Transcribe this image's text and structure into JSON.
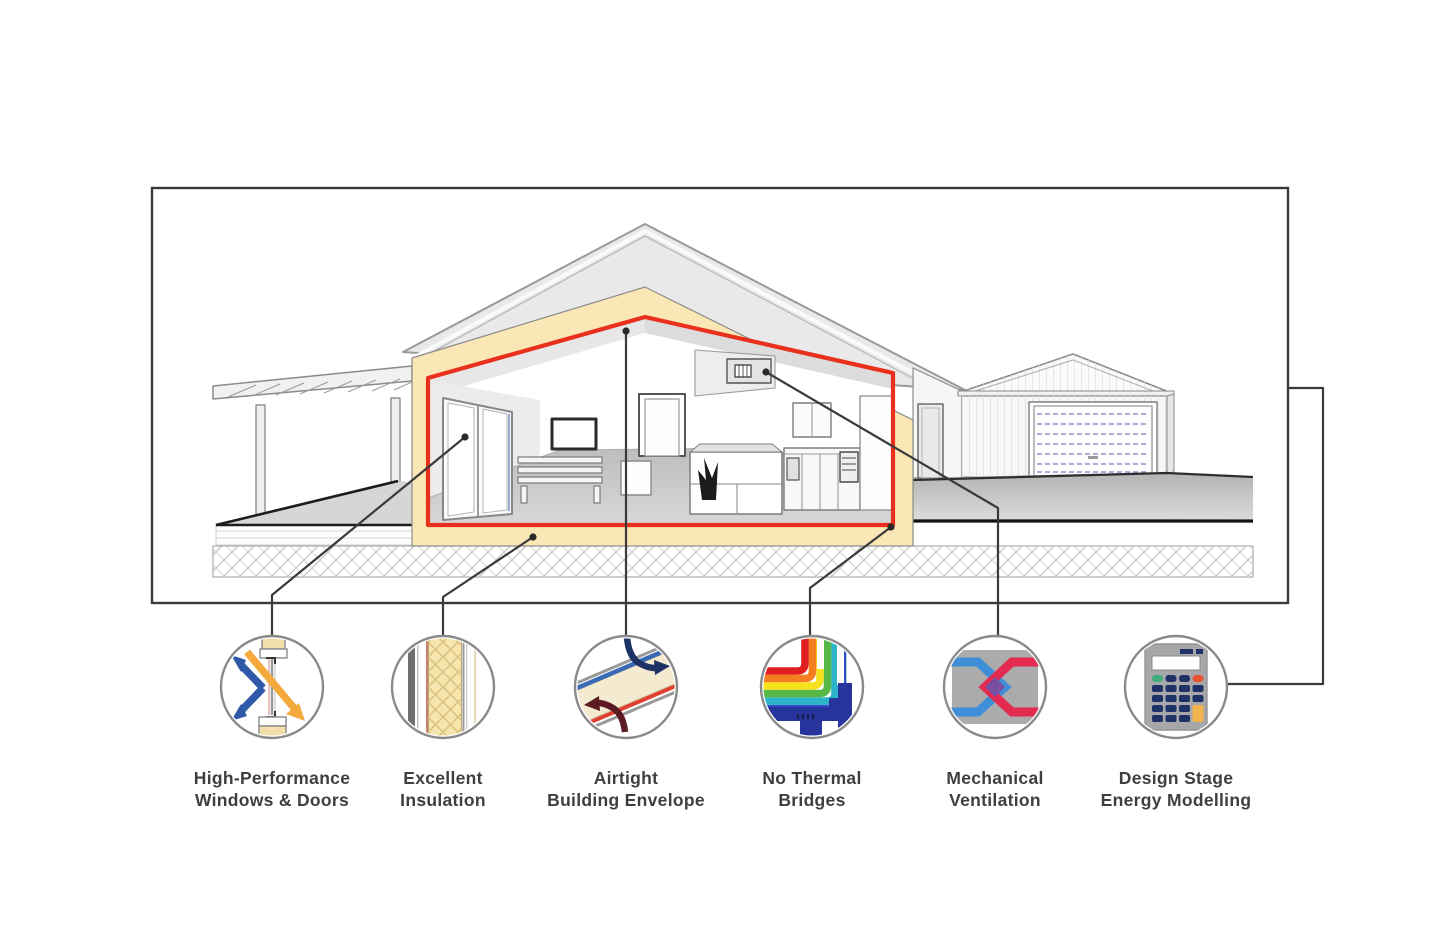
{
  "diagram": {
    "type": "passive-house-features-infographic",
    "background": "#ffffff",
    "colors": {
      "frame_border": "#3a3a3a",
      "leader_line": "#3a3a3a",
      "label_text": "#3f3f3f",
      "circle_stroke": "#8a8a8a",
      "insulation_band": "#fae7b5",
      "airtight_envelope_red": "#e8301d",
      "arrow_blue": "#2d59a8",
      "arrow_orange": "#f4a93d",
      "airtight_arrow_navy": "#1e3365",
      "airtight_arrow_maroon": "#5c1a22",
      "vent_blue": "#3e8fd8",
      "vent_red": "#e32a50",
      "vent_purple": "#7a4fa0",
      "calc_navy": "#1f3268",
      "calc_green": "#3fae7c",
      "calc_red": "#e85331",
      "calc_yellow": "#f2b24c"
    },
    "house_parts": [
      "pergola",
      "deck",
      "main-house-cutaway",
      "insulation-layer",
      "airtight-envelope",
      "interior-living-kitchen",
      "ventilation-unit",
      "breezeway-door",
      "garage",
      "garage-roller-door",
      "driveway",
      "foundation-hatch"
    ]
  },
  "features": [
    {
      "icon": "window-cross-section-icon",
      "label_line1": "High-Performance",
      "label_line2": "Windows & Doors"
    },
    {
      "icon": "insulation-wall-icon",
      "label_line1": "Excellent",
      "label_line2": "Insulation"
    },
    {
      "icon": "airtight-envelope-icon",
      "label_line1": "Airtight",
      "label_line2": "Building Envelope"
    },
    {
      "icon": "thermal-bridge-icon",
      "label_line1": "No Thermal",
      "label_line2": "Bridges"
    },
    {
      "icon": "heat-recovery-ventilation-icon",
      "label_line1": "Mechanical",
      "label_line2": "Ventilation"
    },
    {
      "icon": "calculator-icon",
      "label_line1": "Design Stage",
      "label_line2": "Energy Modelling"
    }
  ]
}
